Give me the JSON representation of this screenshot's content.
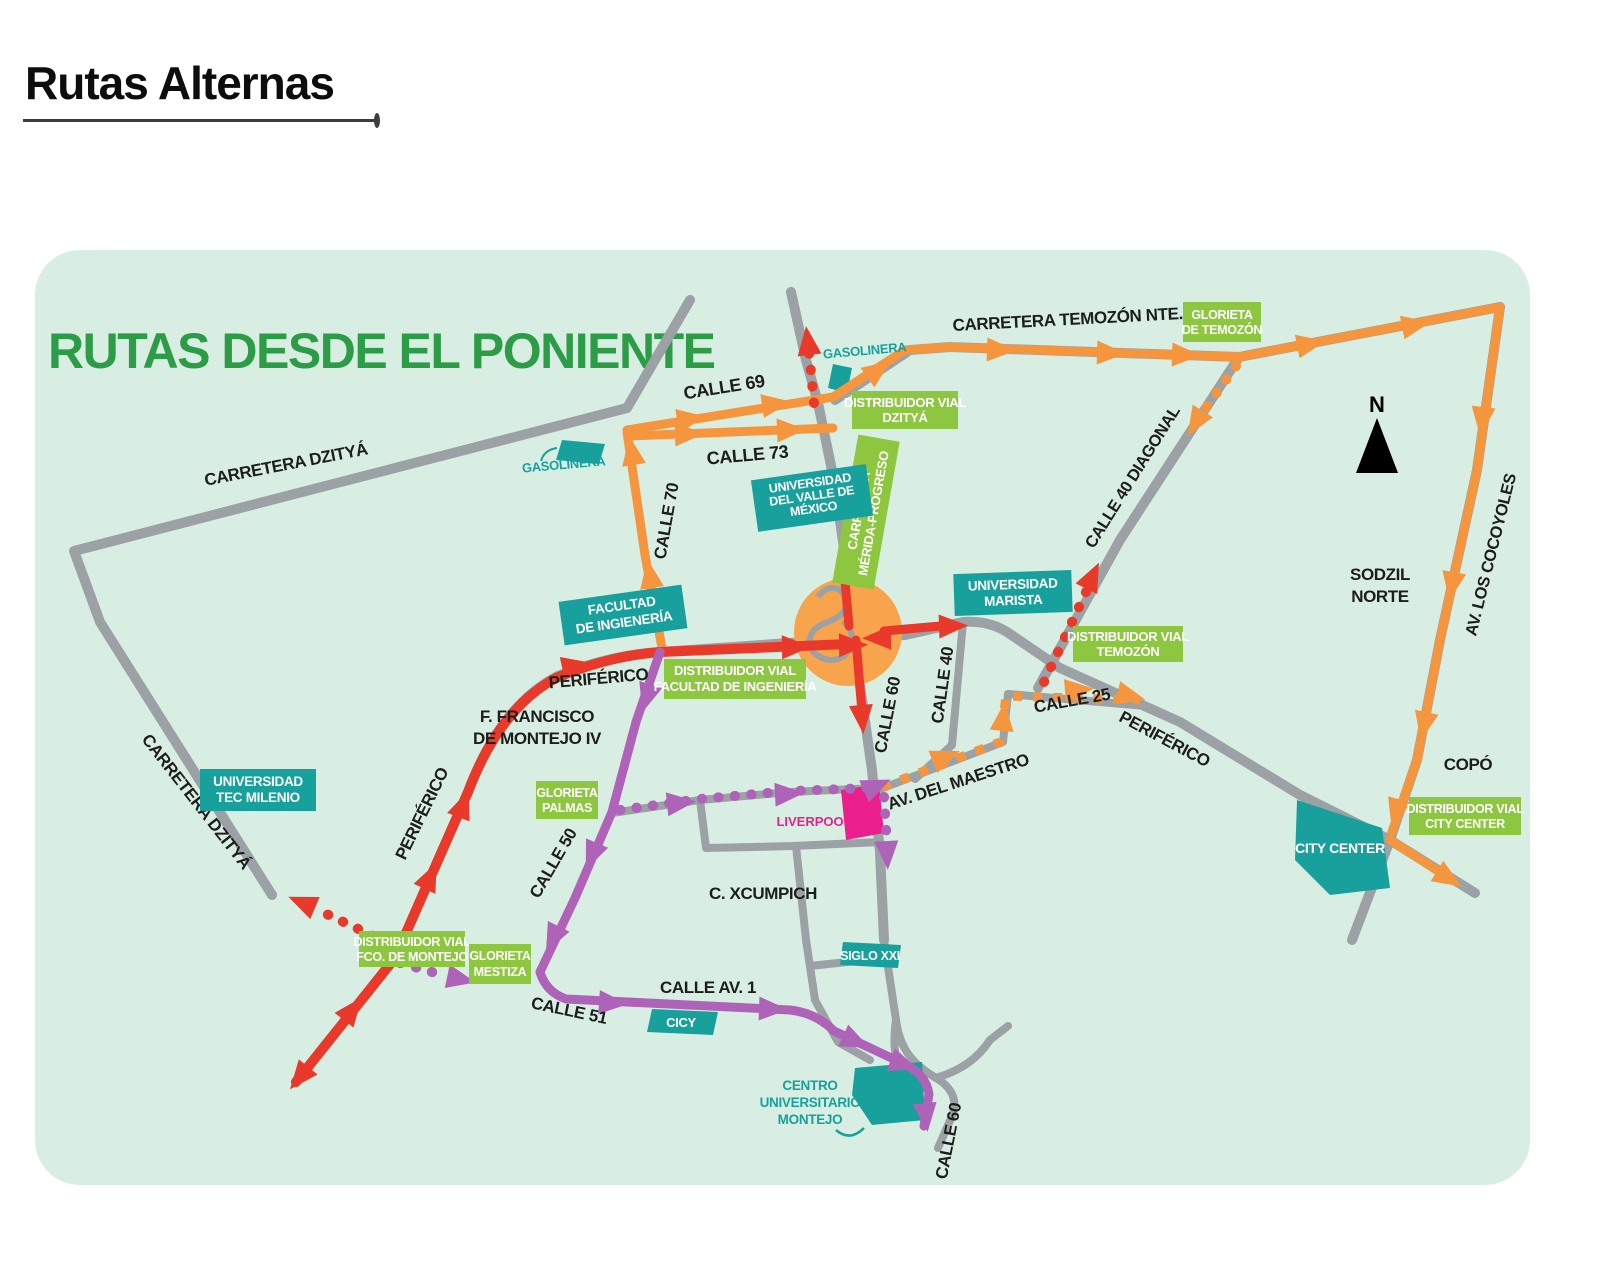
{
  "page": {
    "title": "Rutas Alternas"
  },
  "map": {
    "title": "RUTAS DESDE EL PONIENTE",
    "compass": "N",
    "labels": {
      "carretera_dzitya_north": "CARRETERA DZITYÁ",
      "carretera_dzitya_west": "CARRETERA DZITYÁ",
      "calle_69": "CALLE 69",
      "calle_73": "CALLE 73",
      "calle_70": "CALLE 70",
      "carretera_temozon": "CARRETERA TEMOZÓN NTE.",
      "calle_40_diagonal": "CALLE 40 DIAGONAL",
      "av_los_cocoyoles": "AV. LOS COCOYOLES",
      "sodzil_norte_l1": "SODZIL",
      "sodzil_norte_l2": "NORTE",
      "copo": "COPÓ",
      "periferico_west": "PERIFÉRICO",
      "periferico_sw": "PERIFÉRICO",
      "periferico_east": "PERIFÉRICO",
      "f_francisco_l1": "F. FRANCISCO",
      "f_francisco_l2": "DE MONTEJO IV",
      "calle_60_center": "CALLE 60",
      "calle_40": "CALLE 40",
      "calle_25": "CALLE 25",
      "av_del_maestro": "AV. DEL MAESTRO",
      "c_xcumpich": "C. XCUMPICH",
      "calle_50": "CALLE 50",
      "calle_51": "CALLE 51",
      "calle_av_1": "CALLE AV. 1",
      "calle_60_south": "CALLE 60"
    },
    "places": {
      "gasolinera_north": "GASOLINERA",
      "gasolinera_west": "GASOLINERA",
      "dv_dzitya": {
        "l1": "DISTRIBUIDOR VIAL",
        "l2": "DZITYÁ"
      },
      "glorieta_temozon": {
        "l1": "GLORIETA",
        "l2": "DE TEMOZÓN"
      },
      "univ_valle": {
        "l1": "UNIVERSIDAD",
        "l2": "DEL VALLE DE",
        "l3": "MÉXICO"
      },
      "carretera_mp": {
        "l1": "CARRETERA",
        "l2": "MÉRIDA-PROGRESO"
      },
      "univ_marista": {
        "l1": "UNIVERSIDAD",
        "l2": "MARISTA"
      },
      "dv_temozon": {
        "l1": "DISTRIBUIDOR VIAL",
        "l2": "TEMOZÓN"
      },
      "facultad": {
        "l1": "FACULTAD",
        "l2": "DE INGIENERÍA"
      },
      "dv_facultad": {
        "l1": "DISTRIBUIDOR VIAL",
        "l2": "FACULTAD DE INGENIERÍA"
      },
      "univ_tec": {
        "l1": "UNIVERSIDAD",
        "l2": "TEC MILENIO"
      },
      "glorieta_palmas": {
        "l1": "GLORIETA",
        "l2": "PALMAS"
      },
      "liverpool": "LIVERPOOL",
      "city_center": "CITY CENTER",
      "dv_city_center": {
        "l1": "DISTRIBUIDOR VIAL",
        "l2": "CITY CENTER"
      },
      "dv_fco_montejo": {
        "l1": "DISTRIBUIDOR VIAL",
        "l2": "FCO. DE MONTEJO"
      },
      "glorieta_mestiza": {
        "l1": "GLORIETA",
        "l2": "MESTIZA"
      },
      "cicy": "CICY",
      "siglo_xxi": "SIGLO XXI",
      "centro_univ": {
        "l1": "CENTRO",
        "l2": "UNIVERSITARIO",
        "l3": "MONTEJO"
      }
    }
  },
  "colors": {
    "map_bg": "#d9eee3",
    "title_green": "#2d9c47",
    "road_gray": "#9ba1a4",
    "route_orange": "#f5963f",
    "route_red": "#e8392b",
    "route_purple": "#ae63b9",
    "pink": "#ea1f8d",
    "badge_green": "#8dc63f",
    "badge_teal": "#18a09c",
    "label_black": "#1d1d1b",
    "glorieta_orange": "#f7a44d"
  }
}
